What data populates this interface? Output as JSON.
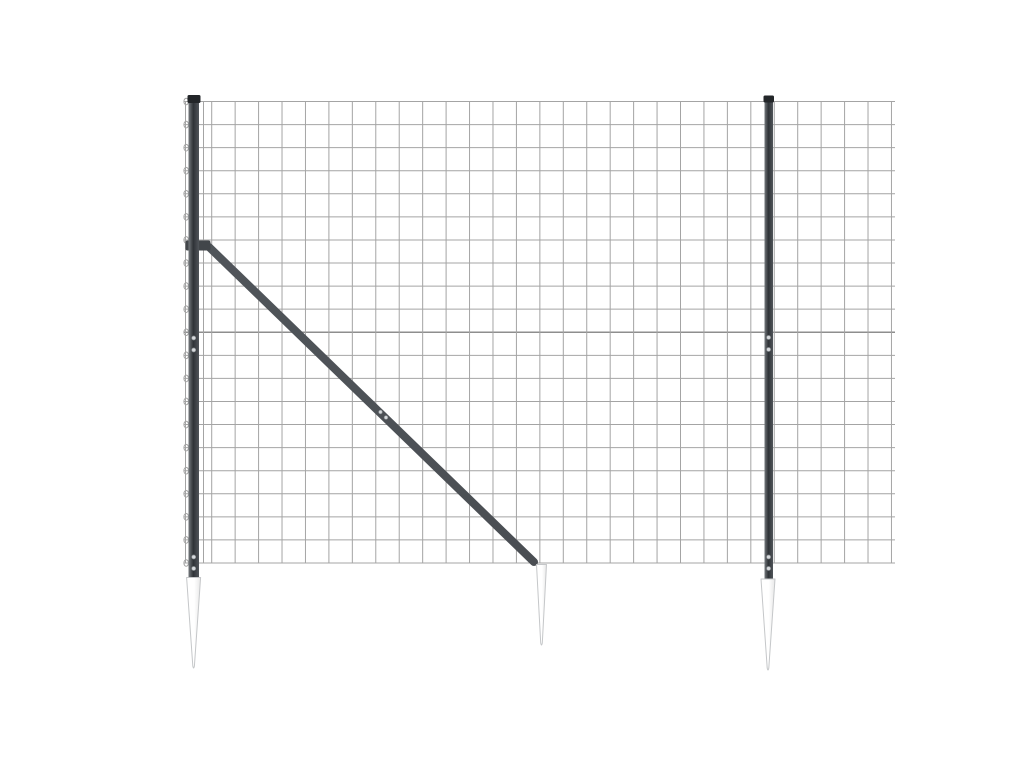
{
  "image": {
    "subject": "wire-mesh-fence-panel-with-anthracite-posts-diagonal-brace-and-ground-spike-anchors",
    "background": "#ffffff",
    "canvas": {
      "width": 1024,
      "height": 768
    }
  },
  "scene": {
    "colors": {
      "wire": "#a4a4a4",
      "wire_tension": "#8e8e8e",
      "post_light": "#74797d",
      "post_dark": "#2f3337",
      "post_mid": "#50555a",
      "post_cap": "#232629",
      "brace": "#4a4e53",
      "clamp": "#42464a",
      "bolt_fill": "#d7dadd",
      "bolt_stroke": "#8b9094",
      "spike_light": "#ffffff",
      "spike_shade": "#e7e7e7",
      "spike_stroke": "#c5c7c9"
    },
    "mesh": {
      "loop_wire_x": 185.5,
      "inner_wire_x": 203.5,
      "grid_start_x": 211.7,
      "col_spacing": 23.44,
      "col_count": 30,
      "top": 101.5,
      "row_spacing": 23.075,
      "row_count": 21,
      "right_edge": 895,
      "tension_row_index": 10,
      "loop_cx": 186.2,
      "loop_rx": 2.3,
      "loop_ry": 3.3
    },
    "posts": [
      {
        "side": "left",
        "cap": {
          "x": 187.5,
          "y": 95,
          "w": 13,
          "h": 8
        },
        "body": {
          "x": 188.5,
          "y": 101,
          "w": 10.5,
          "h": 477
        },
        "bolt_cx": 193.7,
        "bolt_ys": [
          338,
          350,
          557,
          568.5
        ]
      },
      {
        "side": "right",
        "cap": {
          "x": 763.5,
          "y": 95.5,
          "w": 10.5,
          "h": 7
        },
        "body": {
          "x": 764.5,
          "y": 101,
          "w": 8.5,
          "h": 479
        },
        "bolt_cx": 768.6,
        "bolt_ys": [
          337.5,
          349.5,
          557,
          568.5
        ]
      }
    ],
    "brace": {
      "x1": 209,
      "y1": 247,
      "x2": 534,
      "y2": 562,
      "thickness": 8,
      "clamp": {
        "x": 185.5,
        "y": 240.5,
        "w": 25,
        "h": 10
      },
      "bolts": [
        {
          "cx": 380.5,
          "cy": 412
        },
        {
          "cx": 386,
          "cy": 417.5
        }
      ]
    },
    "spikes": [
      {
        "position": "left",
        "cx": 193.6,
        "top": 577.5,
        "tip": 669,
        "top_width": 14
      },
      {
        "position": "middle",
        "cx": 541.5,
        "top": 564.5,
        "tip": 646,
        "top_width": 10
      },
      {
        "position": "right",
        "cx": 768,
        "top": 579,
        "tip": 671,
        "top_width": 14
      }
    ]
  }
}
